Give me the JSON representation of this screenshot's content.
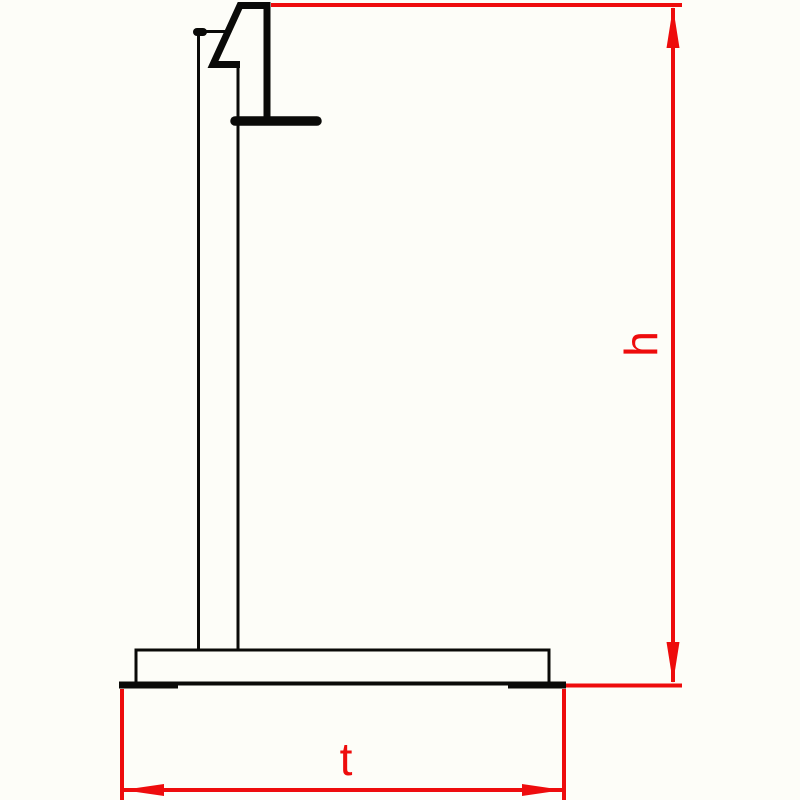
{
  "colors": {
    "background": "#fdfdf8",
    "outline": "#0a0a08",
    "dimension": "#ee0c0c"
  },
  "dimensions": {
    "height": {
      "label": "h",
      "orientation": "vertical"
    },
    "width": {
      "label": "t",
      "orientation": "horizontal"
    }
  }
}
